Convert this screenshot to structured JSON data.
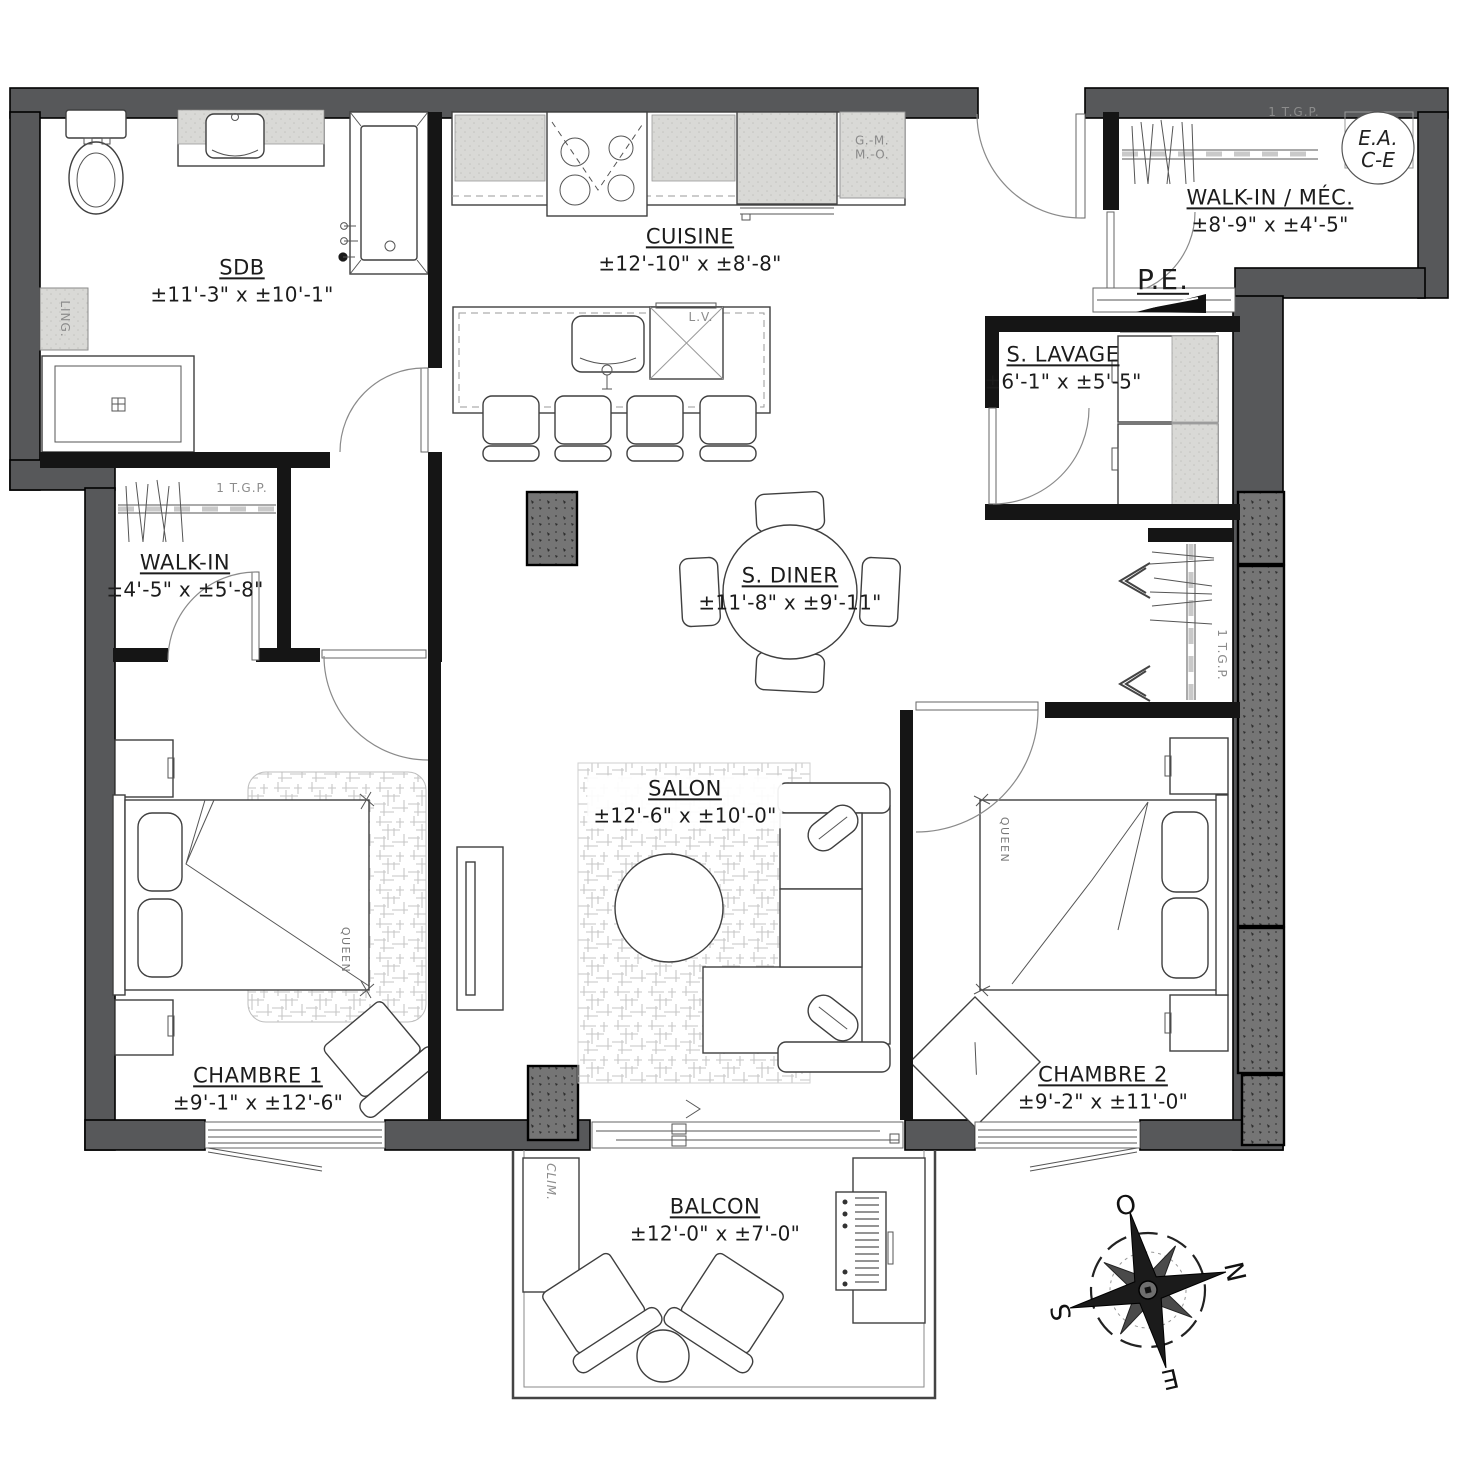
{
  "plan": {
    "rooms": [
      {
        "name": "SDB",
        "dims": "±11'-3\" x ±10'-1\""
      },
      {
        "name": "CUISINE",
        "dims": "±12'-10\" x ±8'-8\""
      },
      {
        "name": "WALK-IN / MÉC.",
        "dims": "±8'-9\" x ±4'-5\""
      },
      {
        "name": "S. LAVAGE",
        "dims": "±6'-1\" x ±5'-5\""
      },
      {
        "name": "WALK-IN",
        "dims": "±4'-5\" x ±5'-8\""
      },
      {
        "name": "S. DINER",
        "dims": "±11'-8\" x ±9'-11\""
      },
      {
        "name": "SALON",
        "dims": "±12'-6\" x ±10'-0\""
      },
      {
        "name": "CHAMBRE 1",
        "dims": "±9'-1\" x ±12'-6\""
      },
      {
        "name": "CHAMBRE 2",
        "dims": "±9'-2\" x ±11'-0\""
      },
      {
        "name": "BALCON",
        "dims": "±12'-0\" x ±7'-0\""
      }
    ],
    "labels": {
      "entry_door": "P.E.",
      "linen": "LING.",
      "ac_unit": "CLIM.",
      "bed_size": "QUEEN",
      "dishwasher": "L.V.",
      "fridge_line1": "G.-M.",
      "fridge_line2": "M.-O.",
      "closet_note": "1 T.G.P.",
      "water_heater_line1": "E.A.",
      "water_heater_line2": "C-E"
    },
    "compass": {
      "west": "O",
      "north": "N",
      "south": "S",
      "east": "E"
    }
  },
  "colors": {
    "wall": "#57585a",
    "concrete": "#757575",
    "appliance": "#d9d9d6",
    "line": "#3f3f3f"
  }
}
